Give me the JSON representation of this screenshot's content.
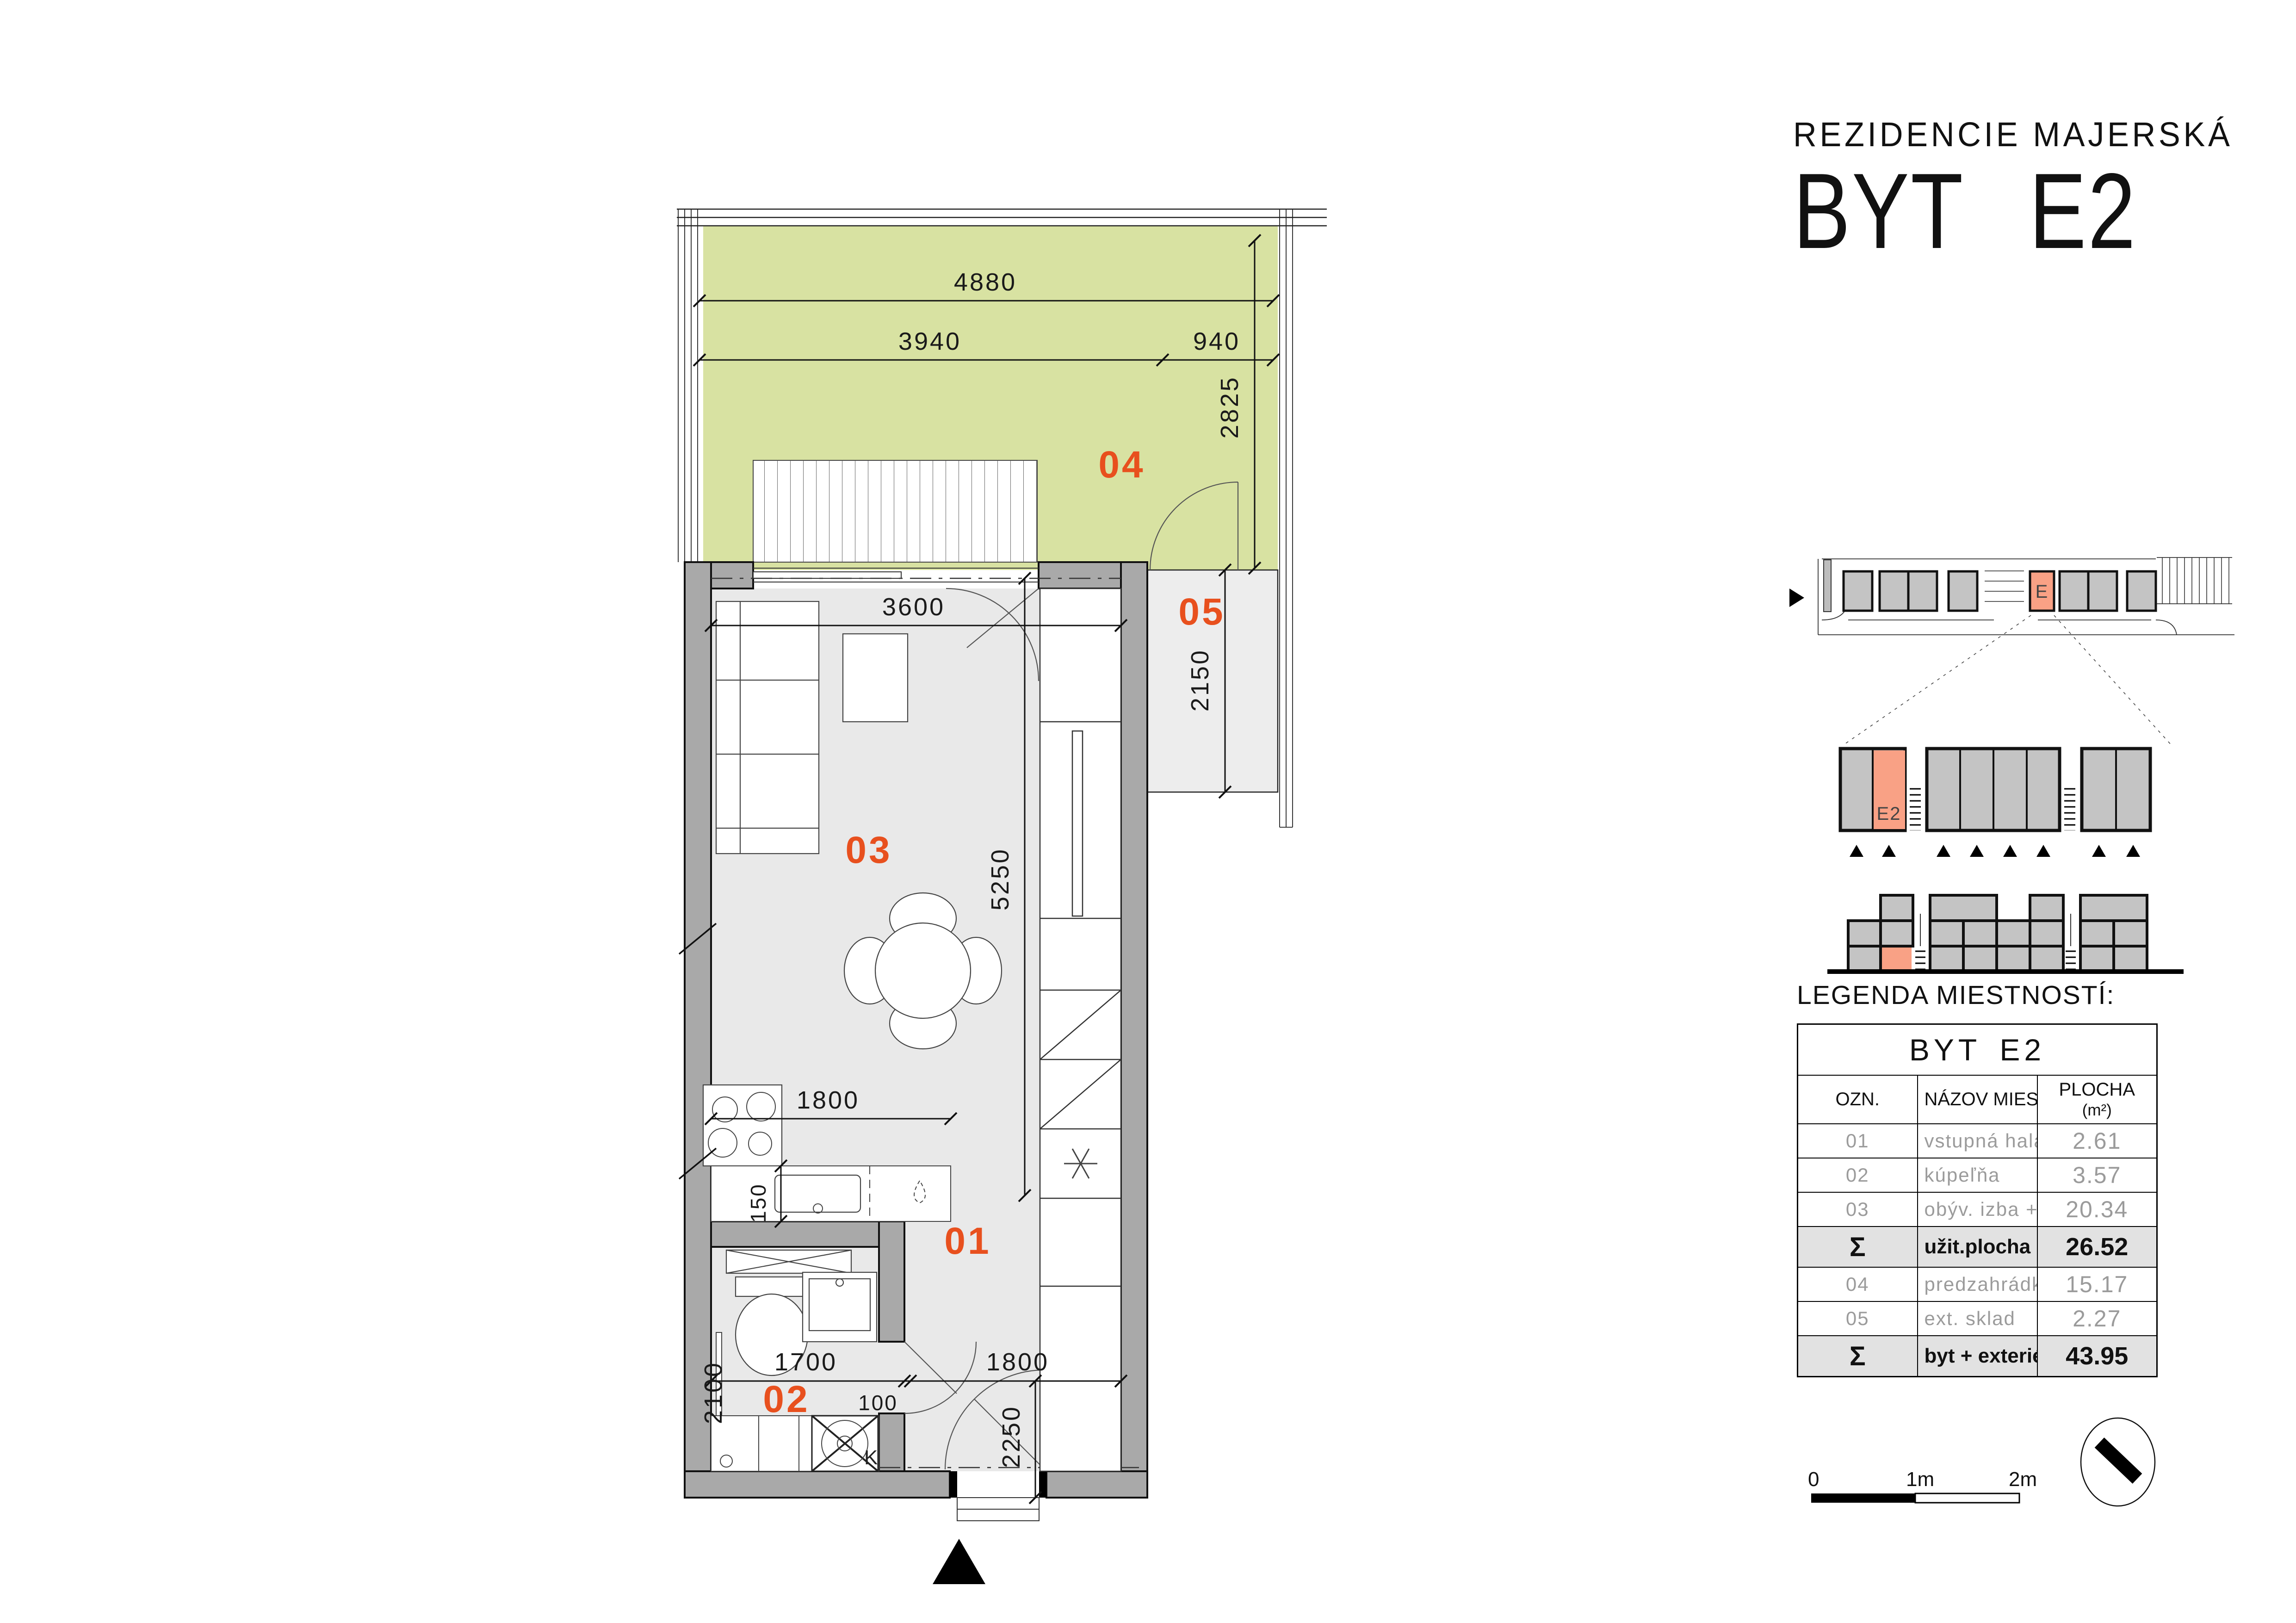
{
  "title": {
    "project": "REZIDENCIE MAJERSKÁ",
    "unit": "BYT E2"
  },
  "plan": {
    "rooms": {
      "r01": "01",
      "r02": "02",
      "r03": "03",
      "r04": "04",
      "r05": "05"
    },
    "dims": {
      "d4880": "4880",
      "d3940": "3940",
      "d940": "940",
      "d2825": "2825",
      "d3600": "3600",
      "d5250": "5250",
      "d2150": "2150",
      "d1800_kitchen": "1800",
      "d150": "150",
      "d1700": "1700",
      "d100": "100",
      "d2100": "2100",
      "d1800_hall": "1800",
      "d2250": "2250"
    },
    "labels": {
      "washer": "K"
    }
  },
  "site": {
    "building_label": "E",
    "unit_label": "E2"
  },
  "legend": {
    "title": "LEGENDA MIESTNOSTÍ:",
    "table_title": "BYT E2",
    "columns": {
      "ozn": "OZN.",
      "name": "NÁZOV MIESTNOSTI",
      "area": "PLOCHA",
      "area_unit": "(m²)"
    },
    "rows": [
      {
        "ozn": "01",
        "name": "vstupná hala",
        "area": "2.61"
      },
      {
        "ozn": "02",
        "name": "kúpeľňa",
        "area": "3.57"
      },
      {
        "ozn": "03",
        "name": "obýv. izba + kuchyňa",
        "area": "20.34"
      }
    ],
    "sum1": {
      "ozn": "Σ",
      "name": "užit.plocha bytu",
      "area": "26.52"
    },
    "rows2": [
      {
        "ozn": "04",
        "name": "predzahrádka",
        "area": "15.17"
      },
      {
        "ozn": "05",
        "name": "ext. sklad",
        "area": "2.27"
      }
    ],
    "sum2": {
      "ozn": "Σ",
      "name": "byt + exteriér",
      "area": "43.95"
    }
  },
  "scalebar": {
    "zero": "0",
    "one": "1m",
    "two": "2m"
  },
  "colors": {
    "accent_orange": "#e8501e",
    "garden_green": "#d8e2a2",
    "unit_salmon": "#f9a185",
    "wall_gray": "#a9a9a9"
  }
}
